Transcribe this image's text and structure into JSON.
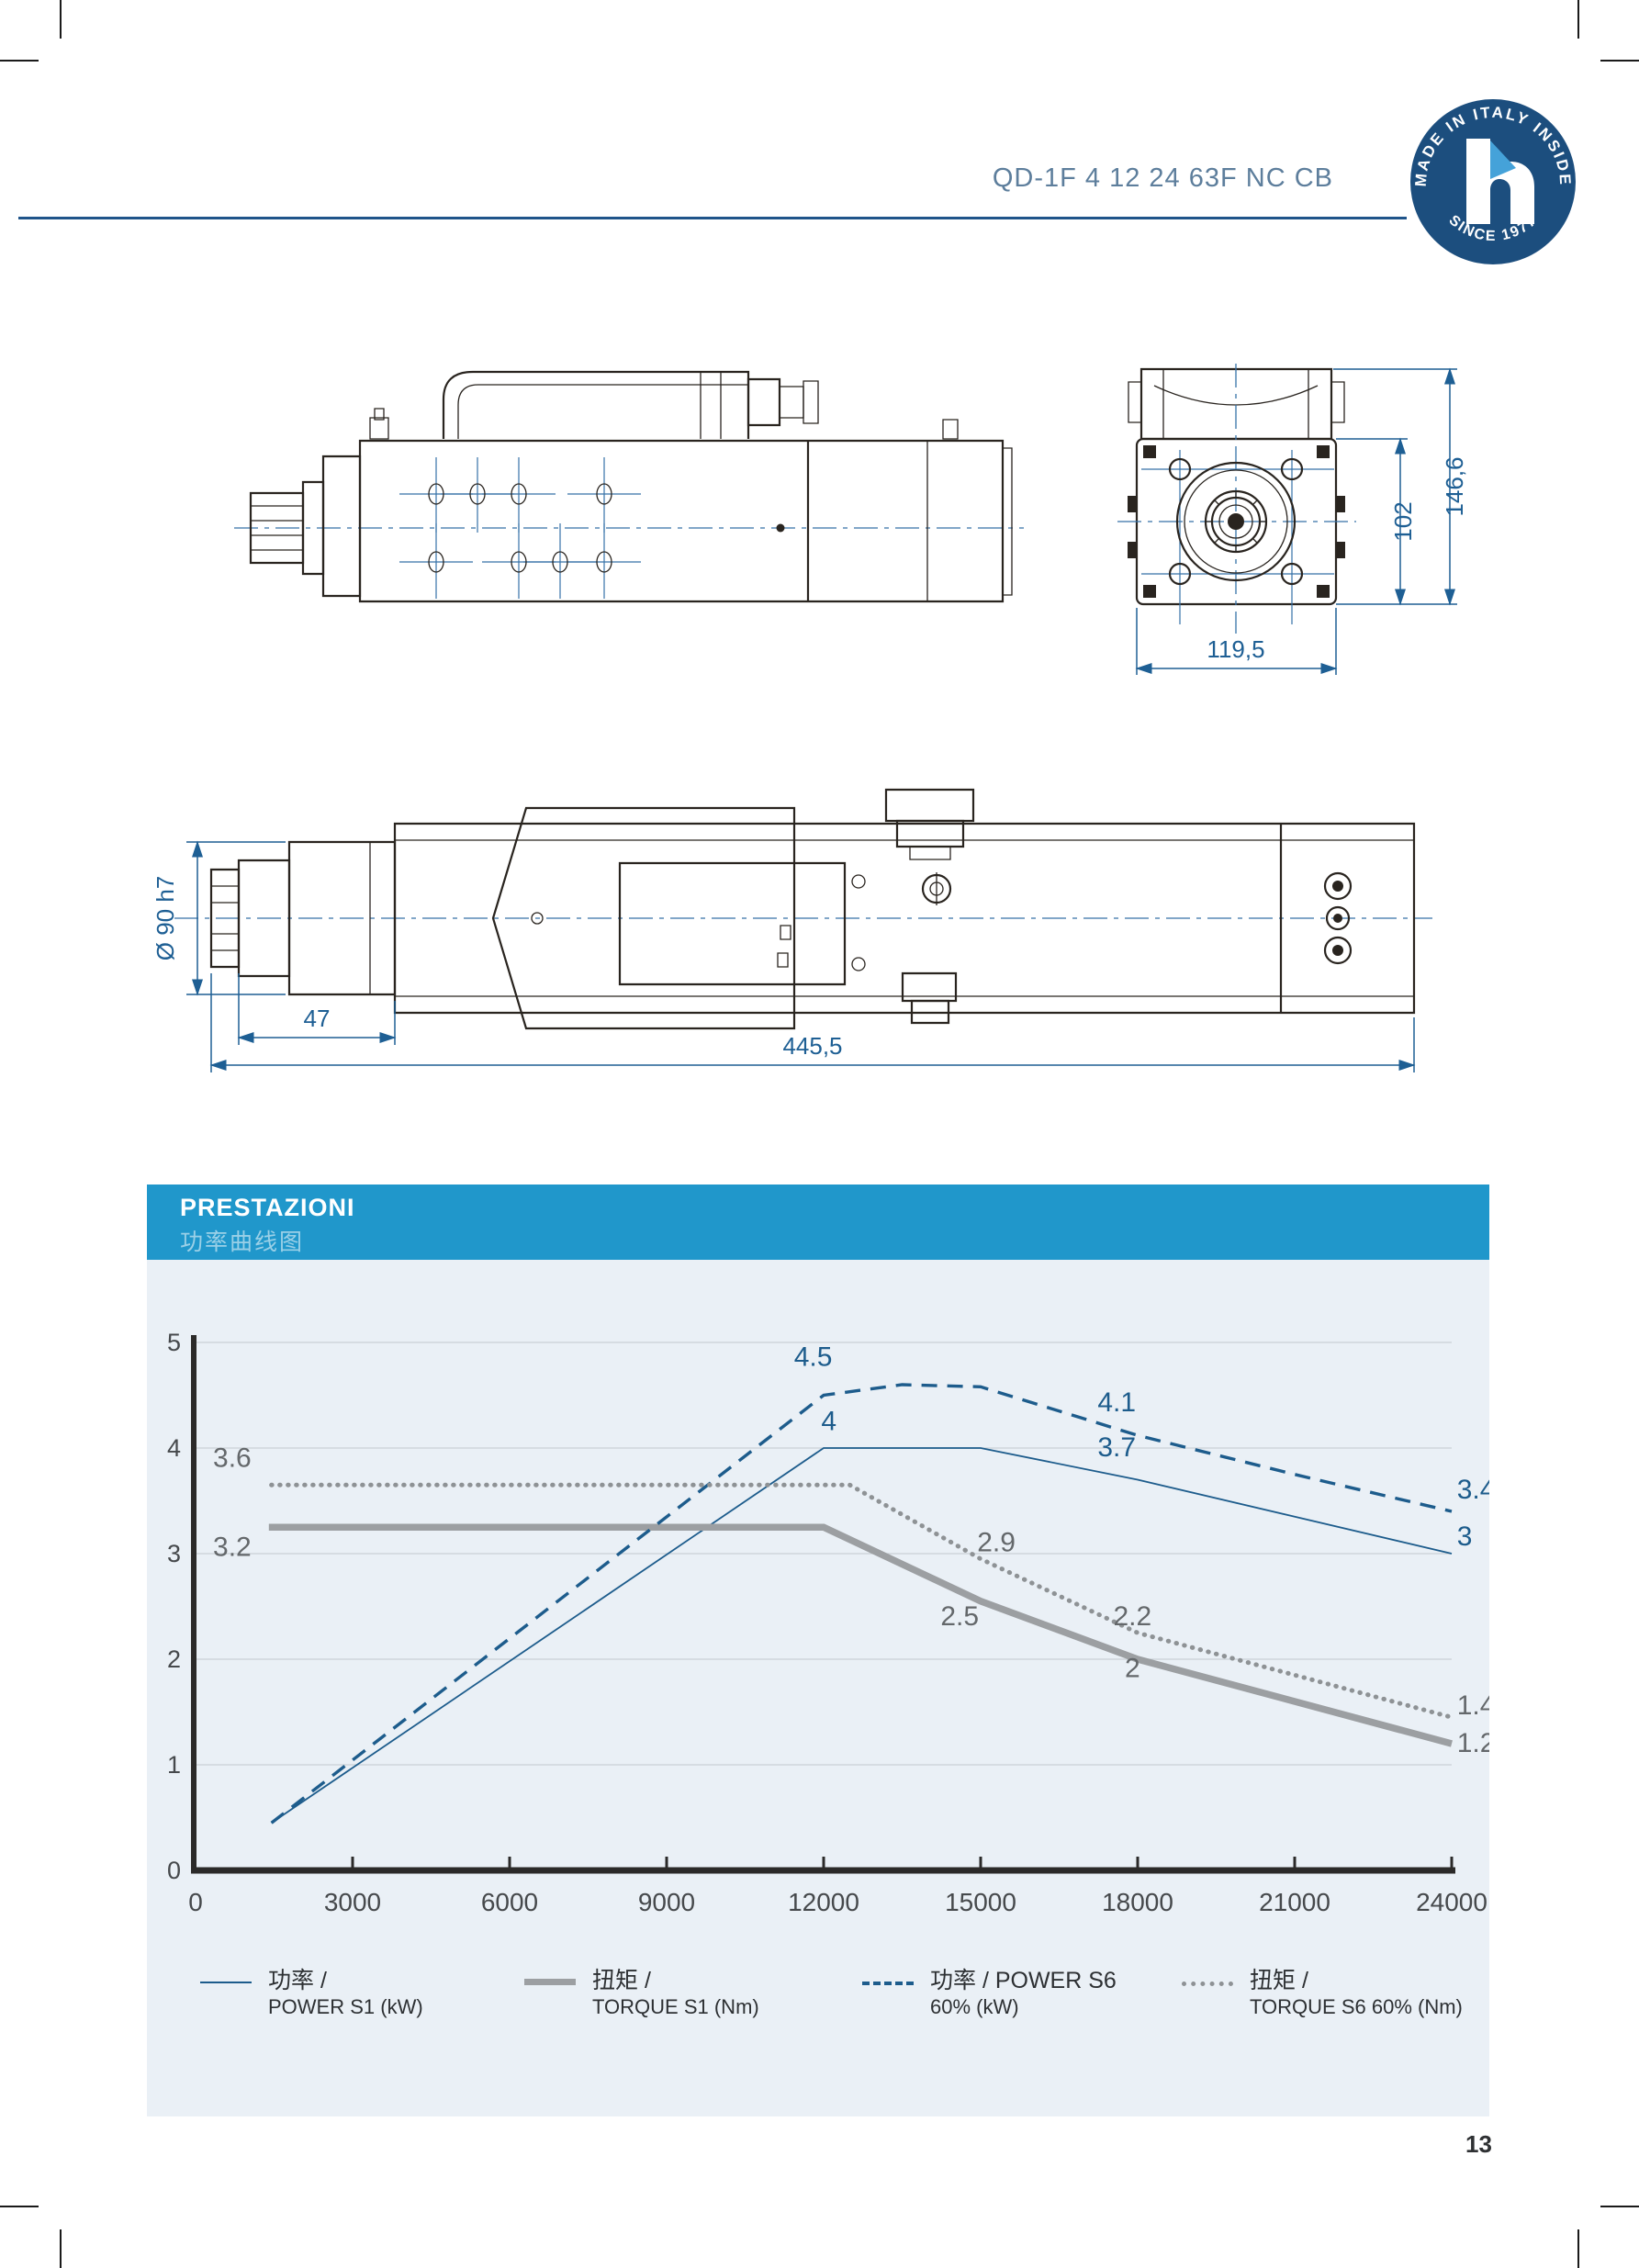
{
  "header": {
    "title": "QD-1F 4 12 24 63F NC CB"
  },
  "badge": {
    "arc_top": "MADE IN ITALY INSIDE",
    "arc_bottom": "SINCE 1977",
    "letter": "h"
  },
  "drawings": {
    "front_view": {
      "dim_total_height": "146,6",
      "dim_body_height": "102",
      "dim_width": "119,5"
    },
    "top_view": {
      "dim_nose_diameter": "Ø 90 h7",
      "dim_nose_length": "47",
      "dim_total_length": "445,5"
    }
  },
  "performance": {
    "title": "PRESTAZIONI",
    "subtitle": "功率曲线图",
    "legend": [
      {
        "zh": "功率 /",
        "en": "POWER S1 (kW)",
        "style": "solid-thin"
      },
      {
        "zh": "扭矩 /",
        "en": "TORQUE S1 (Nm)",
        "style": "solid-thick"
      },
      {
        "zh": "功率 / POWER S6",
        "en": "60% (kW)",
        "style": "dashed"
      },
      {
        "zh": "扭矩 /",
        "en": "TORQUE S6 60% (Nm)",
        "style": "dotted"
      }
    ]
  },
  "chart_data": {
    "type": "line",
    "title": "PRESTAZIONI 功率曲线图",
    "xlabel": "spindle speed (rpm)",
    "ylabel": "",
    "xlim": [
      0,
      24000
    ],
    "ylim": [
      0,
      5
    ],
    "grid": "horizontal",
    "legend_position": "bottom",
    "x_ticks": [
      0,
      3000,
      6000,
      9000,
      12000,
      15000,
      18000,
      21000,
      24000
    ],
    "y_ticks": [
      0,
      1,
      2,
      3,
      4,
      5
    ],
    "series": [
      {
        "name": "POWER S1 (kW)",
        "style": "solid-thin",
        "color": "#1d5c8c",
        "points": [
          [
            1450,
            0.45
          ],
          [
            12000,
            4.0
          ],
          [
            15000,
            4.0
          ],
          [
            18000,
            3.7
          ],
          [
            21000,
            3.35
          ],
          [
            24000,
            3.0
          ]
        ]
      },
      {
        "name": "TORQUE S1 (Nm)",
        "style": "solid-thick",
        "color": "#9c9fa2",
        "points": [
          [
            1400,
            3.25
          ],
          [
            12000,
            3.25
          ],
          [
            15000,
            2.55
          ],
          [
            18000,
            2.0
          ],
          [
            21000,
            1.6
          ],
          [
            24000,
            1.2
          ]
        ]
      },
      {
        "name": "POWER S6 60% (kW)",
        "style": "dashed",
        "color": "#1d5c8c",
        "points": [
          [
            1450,
            0.45
          ],
          [
            12000,
            4.5
          ],
          [
            13500,
            4.6
          ],
          [
            15000,
            4.58
          ],
          [
            18000,
            4.12
          ],
          [
            21000,
            3.75
          ],
          [
            24000,
            3.4
          ]
        ]
      },
      {
        "name": "TORQUE S6 60% (Nm)",
        "style": "dotted",
        "color": "#8e9295",
        "points": [
          [
            1450,
            3.65
          ],
          [
            12500,
            3.65
          ],
          [
            15000,
            2.95
          ],
          [
            18000,
            2.25
          ],
          [
            21000,
            1.85
          ],
          [
            24000,
            1.45
          ]
        ]
      }
    ],
    "annotations": [
      {
        "text": "4.5",
        "x": 11800,
        "y": 4.78,
        "color": "power"
      },
      {
        "text": "4",
        "x": 12100,
        "y": 4.17,
        "color": "power"
      },
      {
        "text": "4.1",
        "x": 17600,
        "y": 4.35,
        "color": "power"
      },
      {
        "text": "3.7",
        "x": 17600,
        "y": 3.92,
        "color": "power"
      },
      {
        "text": "3.4",
        "x": 24100,
        "y": 3.52,
        "color": "power",
        "align": "start"
      },
      {
        "text": "3",
        "x": 24100,
        "y": 3.08,
        "color": "power",
        "align": "start"
      },
      {
        "text": "3.6",
        "x": 700,
        "y": 3.82,
        "color": "torque"
      },
      {
        "text": "3.2",
        "x": 700,
        "y": 2.98,
        "color": "torque"
      },
      {
        "text": "2.9",
        "x": 15300,
        "y": 3.02,
        "color": "torque"
      },
      {
        "text": "2.5",
        "x": 14600,
        "y": 2.32,
        "color": "torque"
      },
      {
        "text": "2.2",
        "x": 17900,
        "y": 2.32,
        "color": "torque"
      },
      {
        "text": "2",
        "x": 17900,
        "y": 1.83,
        "color": "torque"
      },
      {
        "text": "1.4",
        "x": 24100,
        "y": 1.48,
        "color": "torque",
        "align": "start"
      },
      {
        "text": "1.2",
        "x": 24100,
        "y": 1.12,
        "color": "torque",
        "align": "start"
      }
    ]
  },
  "page": {
    "number": "13"
  }
}
